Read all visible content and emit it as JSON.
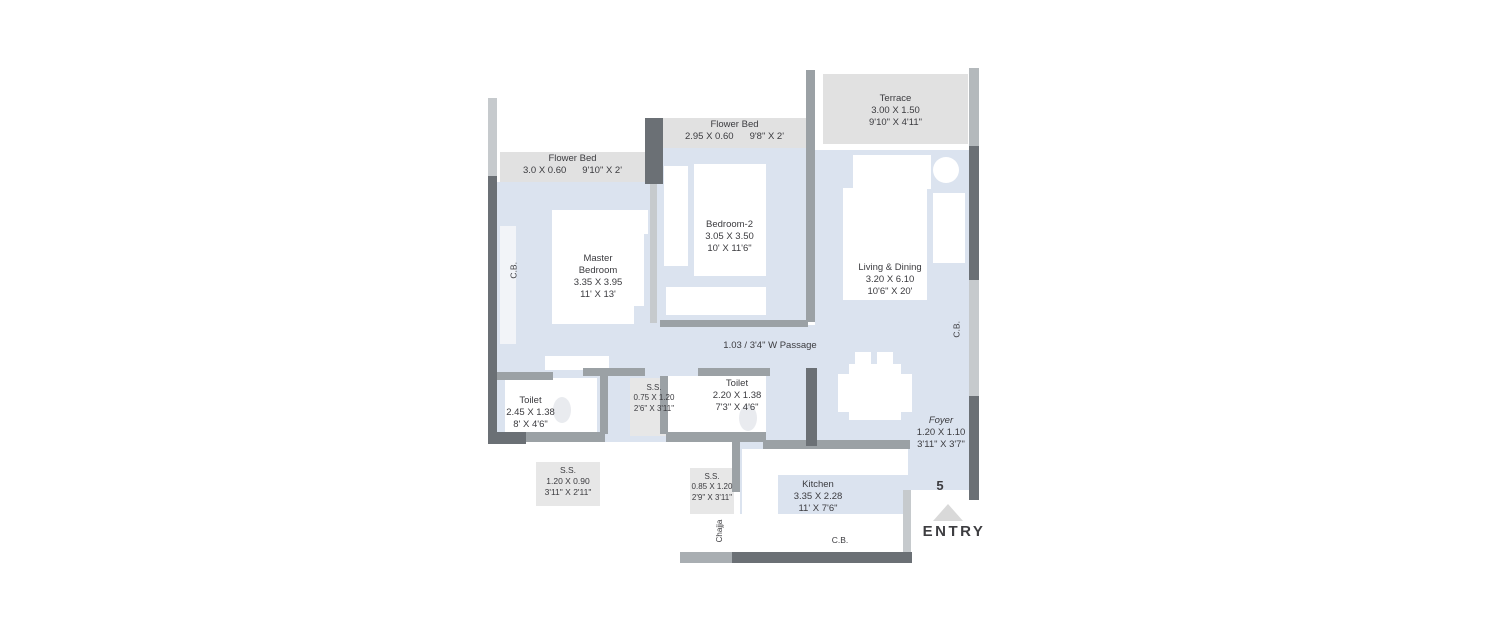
{
  "title": "2BHK Apartment Floor Plan",
  "colors": {
    "background": "#ffffff",
    "floor": "#dbe3ef",
    "surface_gray": "#e1e1e1",
    "wall_dark": "#6b7075",
    "wall_medium": "#9ba1a5",
    "wall_light": "#c6cacd",
    "furniture_white": "#ffffff",
    "text": "#3b3b3f",
    "entry_arrow": "#d9d9d9"
  },
  "labels": {
    "flower_bed_left": {
      "name": "Flower Bed",
      "metric": "3.0 X 0.60",
      "imperial": "9'10\" X 2'"
    },
    "flower_bed_mid": {
      "name": "Flower Bed",
      "metric": "2.95 X 0.60",
      "imperial": "9'8\" X 2'"
    },
    "terrace": {
      "name": "Terrace",
      "metric": "3.00 X 1.50",
      "imperial": "9'10\" X 4'11\""
    },
    "master_bedroom": {
      "name": "Master Bedroom",
      "metric": "3.35 X 3.95",
      "imperial": "11' X 13'"
    },
    "bedroom2": {
      "name": "Bedroom-2",
      "metric": "3.05 X 3.50",
      "imperial": "10' X 11'6\""
    },
    "living_dining": {
      "name": "Living & Dining",
      "metric": "3.20 X 6.10",
      "imperial": "10'6\" X 20'"
    },
    "passage": {
      "name": "1.03 / 3'4\" W Passage"
    },
    "toilet_left": {
      "name": "Toilet",
      "metric": "2.45 X 1.38",
      "imperial": "8' X 4'6\""
    },
    "toilet_mid": {
      "name": "Toilet",
      "metric": "2.20 X 1.38",
      "imperial": "7'3\" X 4'6\""
    },
    "ss_mid": {
      "name": "S.S.",
      "metric": "0.75 X 1.20",
      "imperial": "2'6\" X 3'11\""
    },
    "ss_left": {
      "name": "S.S.",
      "metric": "1.20 X 0.90",
      "imperial": "3'11\" X 2'11\""
    },
    "ss_kitchen": {
      "name": "S.S.",
      "metric": "0.85 X 1.20",
      "imperial": "2'9\" X 3'11\""
    },
    "kitchen": {
      "name": "Kitchen",
      "metric": "3.35 X 2.28",
      "imperial": "11' X 7'6\""
    },
    "foyer": {
      "name": "Foyer",
      "metric": "1.20 X 1.10",
      "imperial": "3'11\" X 3'7\""
    },
    "cb_left": "C.B.",
    "cb_right": "C.B.",
    "cb_bottom": "C.B.",
    "chajja": "Chajja",
    "unit_number": "5",
    "entry": "ENTRY"
  }
}
